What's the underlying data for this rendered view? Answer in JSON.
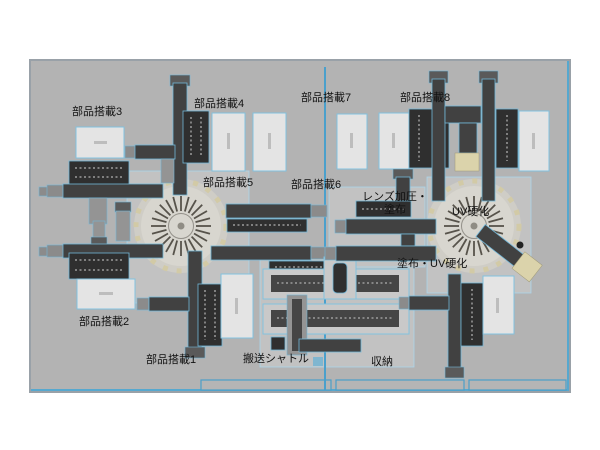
{
  "diagram": {
    "background": "#b3b3b3",
    "border_color": "#99a1a8",
    "accent_blue": "#4aa0cc",
    "machine_dark": "#414141",
    "tray_light": "#e4e4e4",
    "turntable_face": "#d8d6cf",
    "uv_head_beige": "#dbd3ab",
    "labels": {
      "station1": "部品搭載1",
      "station2": "部品搭載2",
      "station3": "部品搭載3",
      "station4": "部品搭載4",
      "station5": "部品搭載5",
      "station6": "部品搭載6",
      "station7": "部品搭載7",
      "station8": "部品搭載8",
      "lens_press_line1": "レンズ加圧・",
      "lens_press_line2": "塗布",
      "uv_cure": "UV硬化",
      "coat_uv_cure": "塗布・UV硬化",
      "shuttle": "搬送シャトル",
      "storage": "収納"
    }
  }
}
